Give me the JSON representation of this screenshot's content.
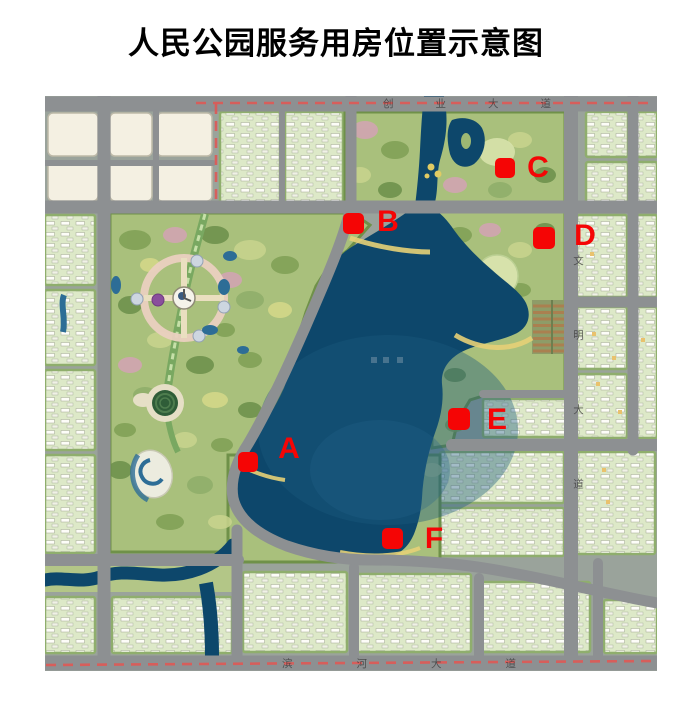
{
  "title": "人民公园服务用房位置示意图",
  "map": {
    "description": "park master plan with lake and service-building location markers",
    "roads": {
      "top_label": "创业大道",
      "bottom_label": "滨河大道",
      "right_label": "文明大道"
    },
    "markers": [
      {
        "id": "A",
        "label": "A",
        "square": {
          "x": 193,
          "y": 356,
          "w": 20,
          "h": 20
        },
        "label_pos": {
          "x": 244,
          "y": 353
        }
      },
      {
        "id": "B",
        "label": "B",
        "square": {
          "x": 298,
          "y": 117,
          "w": 21,
          "h": 21
        },
        "label_pos": {
          "x": 343,
          "y": 126
        }
      },
      {
        "id": "C",
        "label": "C",
        "square": {
          "x": 450,
          "y": 62,
          "w": 20,
          "h": 20
        },
        "label_pos": {
          "x": 493,
          "y": 72
        }
      },
      {
        "id": "D",
        "label": "D",
        "square": {
          "x": 488,
          "y": 131,
          "w": 22,
          "h": 22
        },
        "label_pos": {
          "x": 540,
          "y": 140
        }
      },
      {
        "id": "E",
        "label": "E",
        "square": {
          "x": 403,
          "y": 312,
          "w": 22,
          "h": 22
        },
        "label_pos": {
          "x": 452,
          "y": 324
        }
      },
      {
        "id": "F",
        "label": "F",
        "square": {
          "x": 337,
          "y": 432,
          "w": 21,
          "h": 21
        },
        "label_pos": {
          "x": 389,
          "y": 443
        }
      }
    ],
    "colors": {
      "marker_red": "#f50505",
      "boundary_dash_red": "#dd5a57",
      "lake_blue": "#0d476b",
      "road_gray": "#8d9092",
      "block_green": "#dde9c8",
      "park_green": "#a9c07c",
      "cream_parcel": "#f4f0e2"
    }
  }
}
